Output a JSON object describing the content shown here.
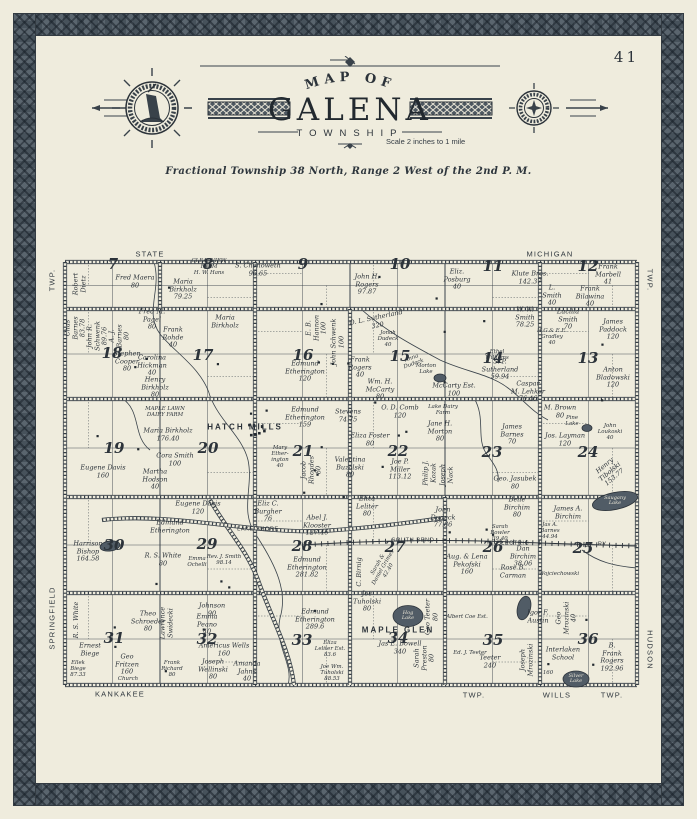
{
  "page": {
    "number": "41"
  },
  "colors": {
    "paper": "#efecdd",
    "ink": "#2c333a",
    "border_slate": "#4e5861",
    "water": "#515c66"
  },
  "header": {
    "arc_title": "MAP OF",
    "title": "GALENA",
    "subtitle": "TOWNSHIP",
    "scale_note": "Scale 2 inches to 1 mile",
    "legal": "Fractional Township 38 North, Range 2 West of the 2nd P. M."
  },
  "map": {
    "sections": [
      {
        "n": "7",
        "x": 51,
        "y": 15
      },
      {
        "n": "8",
        "x": 146,
        "y": 15
      },
      {
        "n": "9",
        "x": 241,
        "y": 15
      },
      {
        "n": "10",
        "x": 338,
        "y": 15
      },
      {
        "n": "11",
        "x": 431,
        "y": 17
      },
      {
        "n": "12",
        "x": 526,
        "y": 17
      },
      {
        "n": "18",
        "x": 50,
        "y": 104
      },
      {
        "n": "17",
        "x": 141,
        "y": 106
      },
      {
        "n": "16",
        "x": 241,
        "y": 106
      },
      {
        "n": "15",
        "x": 338,
        "y": 107
      },
      {
        "n": "14",
        "x": 431,
        "y": 109
      },
      {
        "n": "13",
        "x": 526,
        "y": 109
      },
      {
        "n": "19",
        "x": 52,
        "y": 199
      },
      {
        "n": "20",
        "x": 146,
        "y": 199
      },
      {
        "n": "21",
        "x": 241,
        "y": 202
      },
      {
        "n": "22",
        "x": 336,
        "y": 202
      },
      {
        "n": "23",
        "x": 430,
        "y": 203
      },
      {
        "n": "24",
        "x": 526,
        "y": 203
      },
      {
        "n": "30",
        "x": 52,
        "y": 296
      },
      {
        "n": "29",
        "x": 145,
        "y": 295
      },
      {
        "n": "28",
        "x": 240,
        "y": 297
      },
      {
        "n": "27",
        "x": 333,
        "y": 298
      },
      {
        "n": "26",
        "x": 431,
        "y": 298
      },
      {
        "n": "25",
        "x": 521,
        "y": 299
      },
      {
        "n": "31",
        "x": 52,
        "y": 389
      },
      {
        "n": "32",
        "x": 145,
        "y": 390
      },
      {
        "n": "33",
        "x": 240,
        "y": 391
      },
      {
        "n": "34",
        "x": 336,
        "y": 389
      },
      {
        "n": "35",
        "x": 431,
        "y": 391
      },
      {
        "n": "36",
        "x": 526,
        "y": 390
      }
    ],
    "lakes": [
      {
        "name": "Morton Lake",
        "x": 378,
        "y": 128,
        "rx": 6,
        "ry": 4,
        "rot": 0
      },
      {
        "name": "Pine Lake",
        "x": 525,
        "y": 178,
        "rx": 5,
        "ry": 3.5,
        "rot": 0
      },
      {
        "name": "Saugany Lake",
        "x": 553,
        "y": 251,
        "rx": 23,
        "ry": 8.5,
        "rot": -12
      },
      {
        "name": "Hog Lake",
        "x": 346,
        "y": 366,
        "rx": 15,
        "ry": 10.5,
        "rot": 0
      },
      {
        "name": "Silver Lake",
        "x": 514,
        "y": 429,
        "rx": 13,
        "ry": 8,
        "rot": 0
      },
      {
        "name": "",
        "x": 462,
        "y": 358,
        "rx": 6.5,
        "ry": 12,
        "rot": 14
      },
      {
        "name": "",
        "x": 48,
        "y": 296,
        "rx": 10,
        "ry": 5,
        "rot": -8
      }
    ],
    "labels": [
      {
        "t": "STATE",
        "x": 88,
        "y": 5,
        "c": "road"
      },
      {
        "t": "MICHIGAN",
        "x": 488,
        "y": 5,
        "c": "road"
      },
      {
        "t": "KANKAKEE",
        "x": 58,
        "y": 445,
        "c": "road"
      },
      {
        "t": "TWP.",
        "x": 412,
        "y": 446,
        "c": "road"
      },
      {
        "t": "WILLS",
        "x": 495,
        "y": 446,
        "c": "road"
      },
      {
        "t": "TWP.",
        "x": 550,
        "y": 446,
        "c": "road"
      },
      {
        "t": "TWP.",
        "x": -9,
        "y": 30,
        "c": "road",
        "r": -90
      },
      {
        "t": "SPRINGFIELD",
        "x": -9,
        "y": 368,
        "c": "road",
        "r": -90
      },
      {
        "t": "TWP.",
        "x": 587,
        "y": 30,
        "c": "road",
        "r": 90
      },
      {
        "t": "HUDSON",
        "x": 587,
        "y": 400,
        "c": "road",
        "r": 90
      },
      {
        "t": "HATCH MILLS",
        "x": 183,
        "y": 177,
        "c": "place"
      },
      {
        "t": "MAPLE GLEN",
        "x": 336,
        "y": 380,
        "c": "place"
      },
      {
        "t": "LAKE SHORE",
        "x": 196,
        "y": 280,
        "c": "rr"
      },
      {
        "t": "SOUTH BEND",
        "x": 351,
        "y": 291,
        "c": "rr"
      },
      {
        "t": "ELECTRIC",
        "x": 451,
        "y": 294,
        "c": "rr"
      },
      {
        "t": "RY.",
        "x": 541,
        "y": 295,
        "c": "rr"
      },
      {
        "t": "Robert\nDietz",
        "x": 18,
        "y": 34,
        "r": -90
      },
      {
        "t": "Fred Maera\n80",
        "x": 73,
        "y": 32
      },
      {
        "t": "Maria\nBirkholz\n79.25",
        "x": 121,
        "y": 40
      },
      {
        "t": "CLEARVIEW\nFARM\nH. W. Hans",
        "x": 147,
        "y": 18,
        "c": "tiny"
      },
      {
        "t": "S. Chenoweth\n96.65",
        "x": 196,
        "y": 20
      },
      {
        "t": "John H.\nRogers\n97.87",
        "x": 305,
        "y": 35
      },
      {
        "t": "Eliz.\nPosburg\n40",
        "x": 395,
        "y": 30
      },
      {
        "t": "Klute Bros.\n142.37",
        "x": 468,
        "y": 28
      },
      {
        "t": "Frank\nMarbell\n41",
        "x": 546,
        "y": 25
      },
      {
        "t": "L.\nSmith\n40",
        "x": 490,
        "y": 46
      },
      {
        "t": "Frank\nBilawina\n40",
        "x": 528,
        "y": 47
      },
      {
        "t": "Chas\nBarnes\n83.78",
        "x": 14,
        "y": 78,
        "r": -90
      },
      {
        "t": "John R.\nSchwenk\n89.76",
        "x": 36,
        "y": 86,
        "r": -90
      },
      {
        "t": "A. J.\nBarnes\n80",
        "x": 58,
        "y": 86,
        "r": -90
      },
      {
        "t": "Fred M.\nPagel\n80",
        "x": 90,
        "y": 70
      },
      {
        "t": "Frank\nRohde\n40",
        "x": 111,
        "y": 88
      },
      {
        "t": "Maria\nBirkholz",
        "x": 163,
        "y": 72
      },
      {
        "t": "Stephen\nCooper\n80",
        "x": 65,
        "y": 112
      },
      {
        "t": "Carolina\nHickman\n40",
        "x": 90,
        "y": 116
      },
      {
        "t": "Henry\nBirkholz\n80",
        "x": 93,
        "y": 138
      },
      {
        "t": "E. B.\nHannon\n100",
        "x": 255,
        "y": 78,
        "r": -90
      },
      {
        "t": "John Schwenk\n100",
        "x": 276,
        "y": 92,
        "r": -90
      },
      {
        "t": "Edmund\nEtherington\n120",
        "x": 243,
        "y": 122
      },
      {
        "t": "O. L. Sutherland\n320",
        "x": 315,
        "y": 72,
        "r": -12
      },
      {
        "t": "Jonah\nDudeck\n40",
        "x": 326,
        "y": 90,
        "c": "tiny"
      },
      {
        "t": "Frank\nRogers\n40",
        "x": 298,
        "y": 118
      },
      {
        "t": "Anna\nDudeck",
        "x": 351,
        "y": 112,
        "c": "tiny",
        "r": -20
      },
      {
        "t": "Wm. H.\nMcCarty\n80",
        "x": 318,
        "y": 140
      },
      {
        "t": "McCarty Est.\n100",
        "x": 392,
        "y": 140
      },
      {
        "t": "Morton\nLake",
        "x": 364,
        "y": 120,
        "c": "tiny"
      },
      {
        "t": "W. W.\nSmith\n78.25",
        "x": 463,
        "y": 68
      },
      {
        "t": "Lucilla\nSmith\n70",
        "x": 506,
        "y": 70
      },
      {
        "t": "H.G.& E.E.\nGradley\n40",
        "x": 490,
        "y": 88,
        "c": "tiny"
      },
      {
        "t": "James\nPaddock\n120",
        "x": 551,
        "y": 80
      },
      {
        "t": "Ethel\nWilliams",
        "x": 435,
        "y": 106,
        "c": "tiny"
      },
      {
        "t": "S. P.\nSutherland\n59.94",
        "x": 438,
        "y": 120
      },
      {
        "t": "Caspar\nM. Lehker\n76.46",
        "x": 466,
        "y": 142
      },
      {
        "t": "Anton\nBladowski\n120",
        "x": 551,
        "y": 128
      },
      {
        "t": "Eugene Davis\n160",
        "x": 41,
        "y": 222
      },
      {
        "t": "MAPLE LAWN\nDAIRY FARM",
        "x": 103,
        "y": 163,
        "c": "tiny"
      },
      {
        "t": "Maria Birkholz\n176.40",
        "x": 106,
        "y": 185
      },
      {
        "t": "Cora Smith\n100",
        "x": 113,
        "y": 210
      },
      {
        "t": "Martha\nHodson\n40",
        "x": 93,
        "y": 230
      },
      {
        "t": "Edmund\nEtherington\n159",
        "x": 243,
        "y": 168
      },
      {
        "t": "Mary\nEther-\nington\n40",
        "x": 218,
        "y": 208,
        "c": "tiny"
      },
      {
        "t": "Jacob\nRhoades\n80",
        "x": 250,
        "y": 220,
        "r": -90
      },
      {
        "t": "Stevens\n74.75",
        "x": 286,
        "y": 166
      },
      {
        "t": "O. D. Comb\n120",
        "x": 338,
        "y": 162
      },
      {
        "t": "Lake Dairy\nFarm",
        "x": 381,
        "y": 161,
        "c": "tiny"
      },
      {
        "t": "Jane H.\nMorton\n80",
        "x": 378,
        "y": 182
      },
      {
        "t": "Eliza Foster\n80",
        "x": 308,
        "y": 190
      },
      {
        "t": "Valentina\nBuzolski\n80",
        "x": 288,
        "y": 218
      },
      {
        "t": "Joe P.\nMiller\n113.12",
        "x": 338,
        "y": 220
      },
      {
        "t": "Philip J.\nKozak",
        "x": 368,
        "y": 223,
        "r": -90
      },
      {
        "t": "Joseph\nNack",
        "x": 385,
        "y": 225,
        "r": -90
      },
      {
        "t": "James\nBarnes\n70",
        "x": 450,
        "y": 185
      },
      {
        "t": "M. Brown\n80",
        "x": 498,
        "y": 162
      },
      {
        "t": "Jos. Layman\n120",
        "x": 503,
        "y": 190
      },
      {
        "t": "John Loukoski\n40",
        "x": 548,
        "y": 183,
        "c": "tiny"
      },
      {
        "t": "Pine\nLake",
        "x": 510,
        "y": 172,
        "c": "tiny"
      },
      {
        "t": "Henry Tibolski\n153.77",
        "x": 548,
        "y": 222,
        "r": -40
      },
      {
        "t": "Geo. Jasubek\n80",
        "x": 453,
        "y": 233
      },
      {
        "t": "Eliza\nLeliter\n80",
        "x": 305,
        "y": 257
      },
      {
        "t": "John\nDudeck\n77.86",
        "x": 381,
        "y": 268
      },
      {
        "t": "Belle\nBirchim\n80",
        "x": 455,
        "y": 258
      },
      {
        "t": "James A.\nBirchim",
        "x": 506,
        "y": 263
      },
      {
        "t": "Saugany\nLake",
        "x": 553,
        "y": 251,
        "c": "lakein"
      },
      {
        "t": "Eliz C.\nBurgher\n76",
        "x": 206,
        "y": 262
      },
      {
        "t": "Abel J.\nKlooster\n127.46",
        "x": 255,
        "y": 276
      },
      {
        "t": "Harrison\nBishop\n164.58",
        "x": 26,
        "y": 302
      },
      {
        "t": "Eugene Davis\n120",
        "x": 136,
        "y": 258
      },
      {
        "t": "Edmund\nEtherington",
        "x": 108,
        "y": 277
      },
      {
        "t": "R. S. White\n80",
        "x": 101,
        "y": 310
      },
      {
        "t": "Emma\nOchelli",
        "x": 135,
        "y": 313,
        "c": "tiny"
      },
      {
        "t": "Rev. J. Smith\n98.14",
        "x": 162,
        "y": 311,
        "c": "tiny"
      },
      {
        "t": "Johnson\n90",
        "x": 150,
        "y": 360
      },
      {
        "t": "Emma\nPeano\n40",
        "x": 145,
        "y": 375
      },
      {
        "t": "Theo\nSchroeder\n80",
        "x": 86,
        "y": 372
      },
      {
        "t": "Lawrence\nSwidecki",
        "x": 105,
        "y": 373,
        "r": -90
      },
      {
        "t": "R. S. White",
        "x": 15,
        "y": 370,
        "r": -90
      },
      {
        "t": "Edmund\nEtherington\n281.82",
        "x": 245,
        "y": 318
      },
      {
        "t": "C. Birnig",
        "x": 298,
        "y": 322,
        "r": -90
      },
      {
        "t": "Sarah &\nDaniel Grimes\n42.40",
        "x": 322,
        "y": 318,
        "r": -60,
        "c": "tiny"
      },
      {
        "t": "Joe\nTuholski\n80",
        "x": 305,
        "y": 352
      },
      {
        "t": "Hog\nLake",
        "x": 346,
        "y": 366,
        "c": "lakein"
      },
      {
        "t": "Geo Teeter\n80",
        "x": 370,
        "y": 367,
        "r": -90
      },
      {
        "t": "Aug. & Lena\nPekofski\n160",
        "x": 405,
        "y": 315
      },
      {
        "t": "Albert Coe Est.",
        "x": 405,
        "y": 368,
        "c": "tiny"
      },
      {
        "t": "Dan\nBirchim\n38.06",
        "x": 461,
        "y": 307
      },
      {
        "t": "Rose B.\nCarman",
        "x": 451,
        "y": 322
      },
      {
        "t": "Sarah\nBowler\n39.40",
        "x": 438,
        "y": 284,
        "c": "tiny"
      },
      {
        "t": "Jas A.\nBarnes\n44.94",
        "x": 488,
        "y": 282,
        "c": "tiny"
      },
      {
        "t": "Wojciechowski",
        "x": 497,
        "y": 325,
        "c": "tiny"
      },
      {
        "t": "Ernest\nBiege",
        "x": 28,
        "y": 400
      },
      {
        "t": "Ellek\nBiege\n87.33",
        "x": 16,
        "y": 420,
        "c": "tiny"
      },
      {
        "t": "Geo\nFritzen\n160",
        "x": 65,
        "y": 415
      },
      {
        "t": "Church",
        "x": 66,
        "y": 430,
        "c": "tiny"
      },
      {
        "t": "Frank\nRichard\n80",
        "x": 110,
        "y": 420,
        "c": "tiny"
      },
      {
        "t": "Joseph\nWellinski\n80",
        "x": 151,
        "y": 420
      },
      {
        "t": "Amanda\nJahns\n40",
        "x": 185,
        "y": 422
      },
      {
        "t": "Americus Wells\n160",
        "x": 162,
        "y": 400
      },
      {
        "t": "Edmund\nEtherington\n289.6",
        "x": 253,
        "y": 370
      },
      {
        "t": "Eliza\nLeliter Est.\n83.6",
        "x": 268,
        "y": 400,
        "c": "tiny"
      },
      {
        "t": "Joe Wm.\nTuholski\n88.53",
        "x": 270,
        "y": 424,
        "c": "tiny"
      },
      {
        "t": "Jas E. Bowell\n340",
        "x": 338,
        "y": 398
      },
      {
        "t": "Sarah\nPreston\n80",
        "x": 363,
        "y": 408,
        "r": -90
      },
      {
        "t": "Ed. J. Teeter",
        "x": 408,
        "y": 404,
        "c": "tiny"
      },
      {
        "t": "Teeter\n240",
        "x": 428,
        "y": 412
      },
      {
        "t": "Igor F.\nAustin",
        "x": 476,
        "y": 367
      },
      {
        "t": "Geo\nMrozinski\n40",
        "x": 505,
        "y": 368,
        "r": -90
      },
      {
        "t": "Joseph\nMrozinski",
        "x": 465,
        "y": 410,
        "r": -90
      },
      {
        "t": "Interlaken\nSchool",
        "x": 501,
        "y": 404
      },
      {
        "t": "160",
        "x": 486,
        "y": 424,
        "c": "tiny"
      },
      {
        "t": "Silver\nLake",
        "x": 514,
        "y": 429,
        "c": "lakein"
      },
      {
        "t": "B. Frank\nRogers\n192.96",
        "x": 550,
        "y": 408
      }
    ]
  }
}
